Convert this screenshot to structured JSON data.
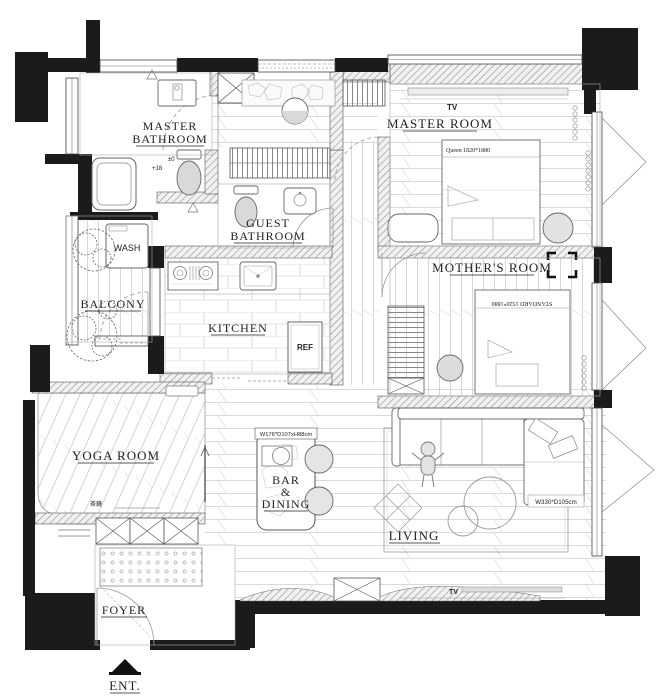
{
  "meta": {
    "background": "#ffffff",
    "wall_color": "#1b1b1b",
    "line_color": "#666666",
    "hatch_color": "#8a8a8a"
  },
  "rooms": {
    "master_bathroom": {
      "name_line1": "MASTER",
      "name_line2": "BATHROOM",
      "level_upper": "±0",
      "level_lower": "+18"
    },
    "wash": {
      "label": "WASH"
    },
    "balcony": {
      "label": "BALCONY"
    },
    "guest_bathroom": {
      "name_line1": "GUEST",
      "name_line2": "BATHROOM"
    },
    "kitchen": {
      "label": "KITCHEN",
      "fridge": "REF"
    },
    "master_room": {
      "label": "MASTER ROOM",
      "tv": "TV",
      "bed": "Queen 1820*1880"
    },
    "mothers_room": {
      "label": "MOTHER'S ROOM",
      "bed": "STANDARD 1520*1880"
    },
    "yoga_room": {
      "label": "YOGA ROOM",
      "mirror_note": "茶鏡"
    },
    "bar_dining": {
      "name_line1": "BAR",
      "name_line2": "&",
      "name_line3": "DINING",
      "table_size": "W176*D107xH88cm"
    },
    "living": {
      "label": "LIVING",
      "sofa_size": "W330*D105cm",
      "tv": "TV"
    },
    "foyer": {
      "label": "FOYER"
    },
    "entrance": {
      "label": "ENT."
    }
  },
  "symbols": {
    "entrance_arrow": "solid-triangle-up",
    "plant": "deciduous-tree",
    "door": "quarter-arc-swing",
    "column": "x-crossed-box"
  }
}
